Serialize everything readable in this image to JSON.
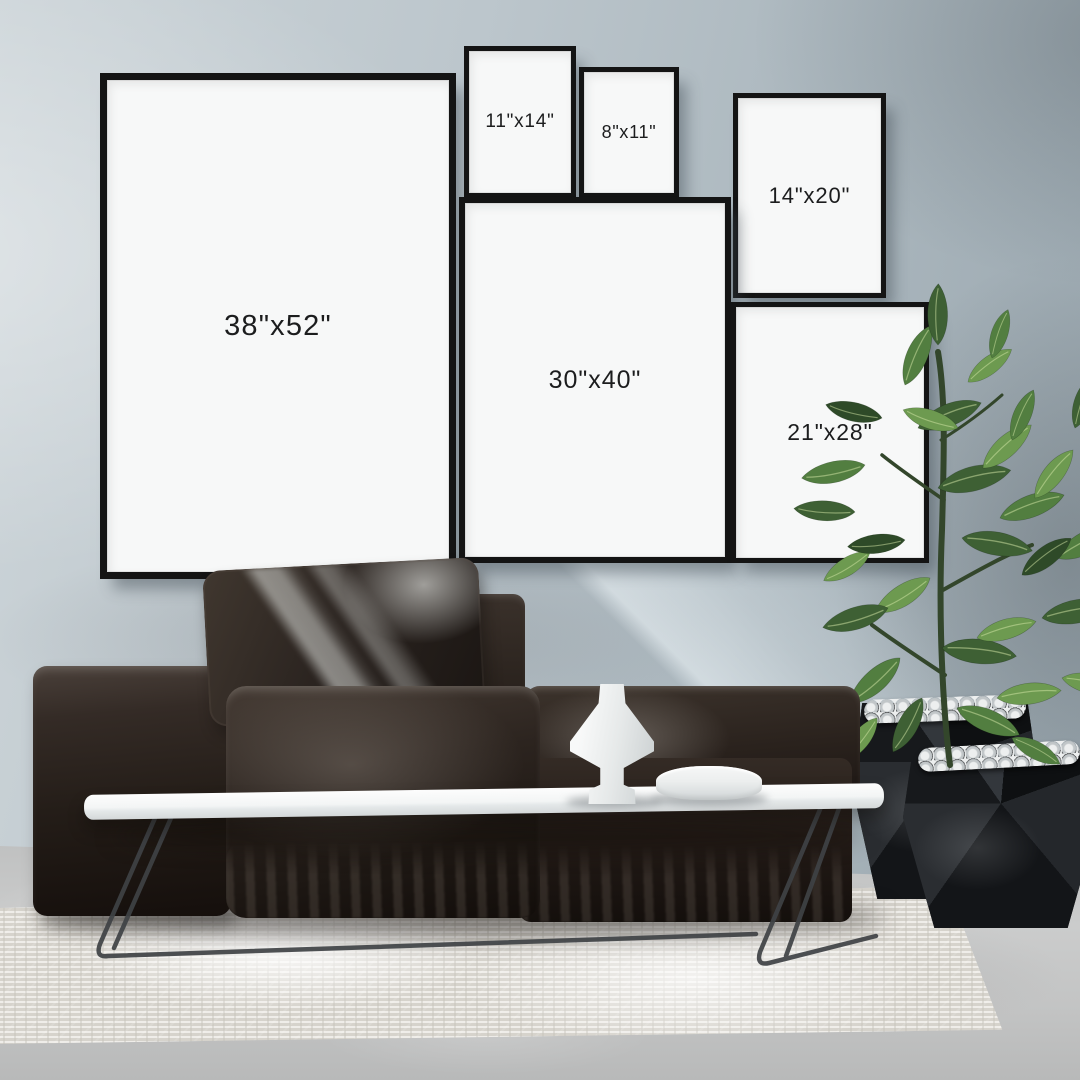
{
  "frames": [
    {
      "id": "38x52",
      "label": "38\"x52\""
    },
    {
      "id": "11x14",
      "label": "11\"x14\""
    },
    {
      "id": "8x11",
      "label": "8\"x11\""
    },
    {
      "id": "14x20",
      "label": "14\"x20\""
    },
    {
      "id": "30x40",
      "label": "30\"x40\""
    },
    {
      "id": "21x28",
      "label": "21\"x28\""
    }
  ],
  "palette": {
    "wall": "#b7c2c8",
    "wall_light": "#ccd4d8",
    "wall_dark": "#96a2aa",
    "frame_border": "#141414",
    "frame_paper": "#f7f8f8",
    "label_text": "#1c1d1e",
    "sofa_dark": "#1c1613",
    "sofa_mid": "#352c25",
    "table_top": "#f4f6f6",
    "table_leg": "#3f4245",
    "rug": "#e7e4dd",
    "floor": "#c6c7c7",
    "planter": "#191b1e",
    "pebbles": "#dfe2e3",
    "plant_green": "#527e40",
    "vase": "#eef0f0"
  }
}
